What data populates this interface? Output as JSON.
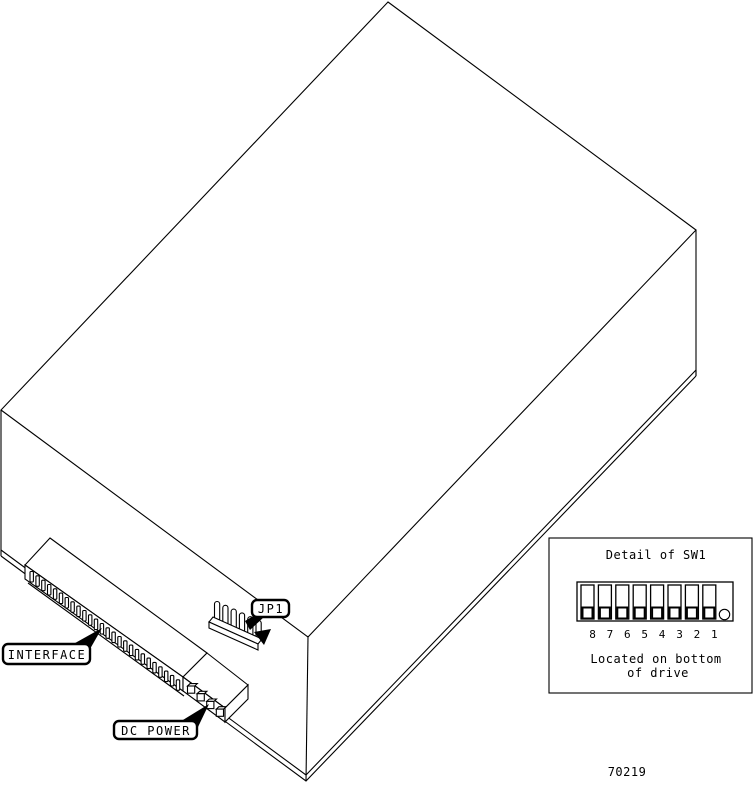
{
  "drawing": {
    "part_number": "70219",
    "line_color": "#000000",
    "background_color": "#ffffff"
  },
  "callouts": {
    "interface_label": "INTERFACE",
    "dc_power_label": "DC POWER",
    "jp1_label": "JP1"
  },
  "connectors": {
    "interface_pin_count": 26,
    "dc_power_pin_count": 4,
    "jp1_pin_count": 6
  },
  "detail_panel": {
    "title": "Detail of SW1",
    "switch_count": 8,
    "switch_numbers": [
      "8",
      "7",
      "6",
      "5",
      "4",
      "3",
      "2",
      "1"
    ],
    "switch_positions": [
      "down",
      "down",
      "down",
      "down",
      "down",
      "down",
      "down",
      "down"
    ],
    "note_line_1": "Located on bottom",
    "note_line_2": "of drive"
  }
}
